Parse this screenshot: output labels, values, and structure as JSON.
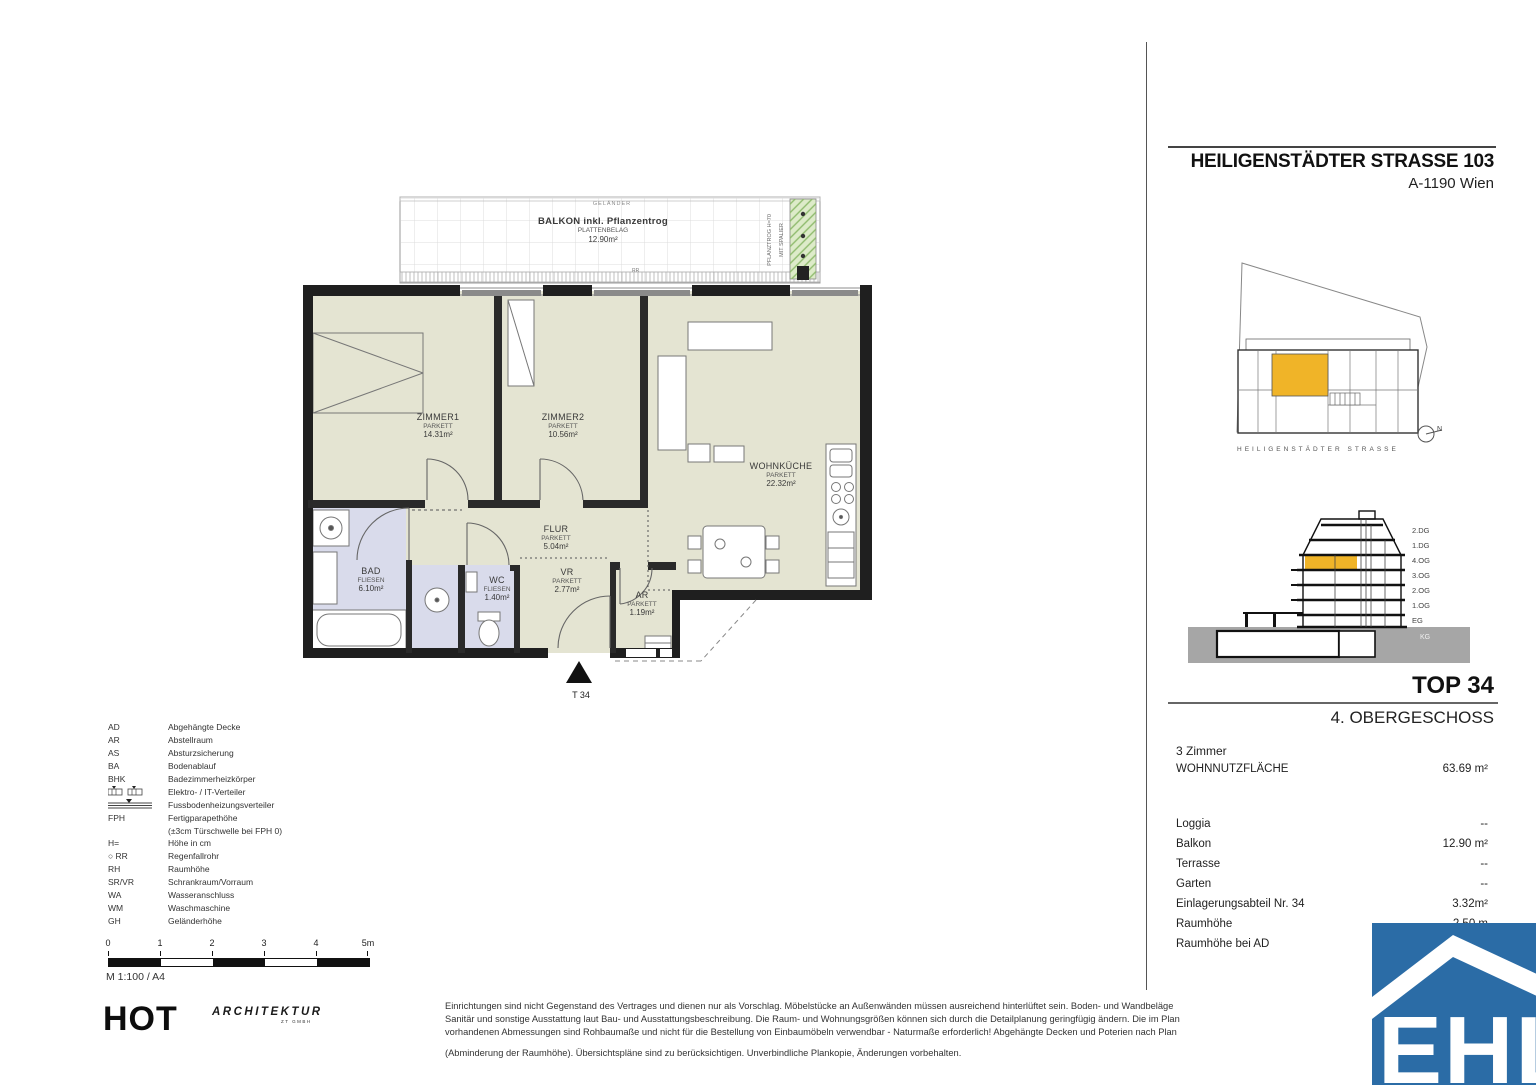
{
  "header": {
    "title": "HEILIGENSTÄDTER STRASSE 103",
    "subtitle": "A-1190 Wien"
  },
  "site_plan": {
    "street_label": "HEILIGENSTÄDTER STRASSE",
    "north_label": "N",
    "highlight_color": "#f0b428"
  },
  "building_section": {
    "floors": [
      "2.DG",
      "1.DG",
      "4.OG",
      "3.OG",
      "2.OG",
      "1.OG",
      "EG"
    ],
    "basement_label": "KG",
    "highlight_color": "#f0b428"
  },
  "unit_info": {
    "unit_number": "TOP 34",
    "floor_name": "4. OBERGESCHOSS",
    "rooms_summary": "3 Zimmer",
    "main_area_label": "WOHNNUTZFLÄCHE",
    "main_area_value": "63.69 m²",
    "details": [
      {
        "label": "Loggia",
        "value": "--"
      },
      {
        "label": "Balkon",
        "value": "12.90 m²"
      },
      {
        "label": "Terrasse",
        "value": "--"
      },
      {
        "label": "Garten",
        "value": "--"
      },
      {
        "label": "Einlagerungsabteil Nr. 34",
        "value": "3.32m²"
      },
      {
        "label": "Raumhöhe",
        "value": "2.50 m"
      },
      {
        "label": "Raumhöhe bei AD",
        "value": ""
      }
    ]
  },
  "floor_plan": {
    "balcony": {
      "railing_label": "GELÄNDER",
      "name": "BALKON inkl. Pflanzentrog",
      "finish": "PLATTENBELAG",
      "area": "12.90m²",
      "planter_label_1": "PFLANZTROG H=70",
      "planter_label_2": "MIT SPALIER",
      "drain_label": "RR"
    },
    "rooms": [
      {
        "name": "ZIMMER1",
        "finish": "PARKETT",
        "area": "14.31m²"
      },
      {
        "name": "ZIMMER2",
        "finish": "PARKETT",
        "area": "10.56m²"
      },
      {
        "name": "WOHNKÜCHE",
        "finish": "PARKETT",
        "area": "22.32m²"
      },
      {
        "name": "FLUR",
        "finish": "PARKETT",
        "area": "5.04m²"
      },
      {
        "name": "BAD",
        "finish": "FLIESEN",
        "area": "6.10m²"
      },
      {
        "name": "WC",
        "finish": "FLIESEN",
        "area": "1.40m²"
      },
      {
        "name": "VR",
        "finish": "PARKETT",
        "area": "2.77m²"
      },
      {
        "name": "AR",
        "finish": "PARKETT",
        "area": "1.19m²"
      }
    ],
    "entrance_label": "T 34"
  },
  "legend": {
    "items": [
      {
        "abbr": "AD",
        "desc": "Abgehängte Decke"
      },
      {
        "abbr": "AR",
        "desc": "Abstellraum"
      },
      {
        "abbr": "AS",
        "desc": "Absturzsicherung"
      },
      {
        "abbr": "BA",
        "desc": "Bodenablauf"
      },
      {
        "abbr": "BHK",
        "desc": "Badezimmerheizkörper"
      },
      {
        "abbr": "",
        "desc": "Elektro- / IT-Verteiler"
      },
      {
        "abbr": "",
        "desc": "Fussbodenheizungsverteiler"
      },
      {
        "abbr": "FPH",
        "desc": "Fertigparapethöhe"
      },
      {
        "abbr": "",
        "desc": "(±3cm Türschwelle bei FPH 0)"
      },
      {
        "abbr": "H=",
        "desc": "Höhe in cm"
      },
      {
        "abbr": "○ RR",
        "desc": "Regenfallrohr"
      },
      {
        "abbr": "RH",
        "desc": "Raumhöhe"
      },
      {
        "abbr": "SR/VR",
        "desc": "Schrankraum/Vorraum"
      },
      {
        "abbr": "WA",
        "desc": "Wasseranschluss"
      },
      {
        "abbr": "WM",
        "desc": "Waschmaschine"
      },
      {
        "abbr": "GH",
        "desc": "Geländerhöhe"
      }
    ]
  },
  "scale_bar": {
    "ticks": [
      "0",
      "1",
      "2",
      "3",
      "4",
      "5m"
    ],
    "note": "M 1:100 / A4"
  },
  "footer": {
    "architect_name": "HOT",
    "architect_suffix": "ARCHITEKTUR",
    "architect_sub": "ZT GMBH",
    "disclaimer_lines": [
      "Einrichtungen sind nicht Gegenstand des Vertrages und dienen nur als Vorschlag. Möbelstücke an Außenwänden müssen ausreichend hinterlüftet sein. Boden- und Wandbeläge",
      "Sanitär und sonstige Ausstattung laut Bau- und Ausstattungsbeschreibung. Die Raum- und Wohnungsgrößen können sich durch die Detailplanung geringfügig ändern. Die im Plan",
      "vorhandenen Abmessungen sind Rohbaumaße und nicht für die Bestellung von Einbaumöbeln verwendbar - Naturmaße erforderlich! Abgehängte Decken und Poterien nach Plan",
      "(Abminderung der Raumhöhe). Übersichtspläne sind zu berücksichtigen. Unverbindliche Plankopie, Änderungen vorbehalten."
    ]
  },
  "ehl_logo": {
    "text": "EHL",
    "color": "#2b6ca6"
  }
}
